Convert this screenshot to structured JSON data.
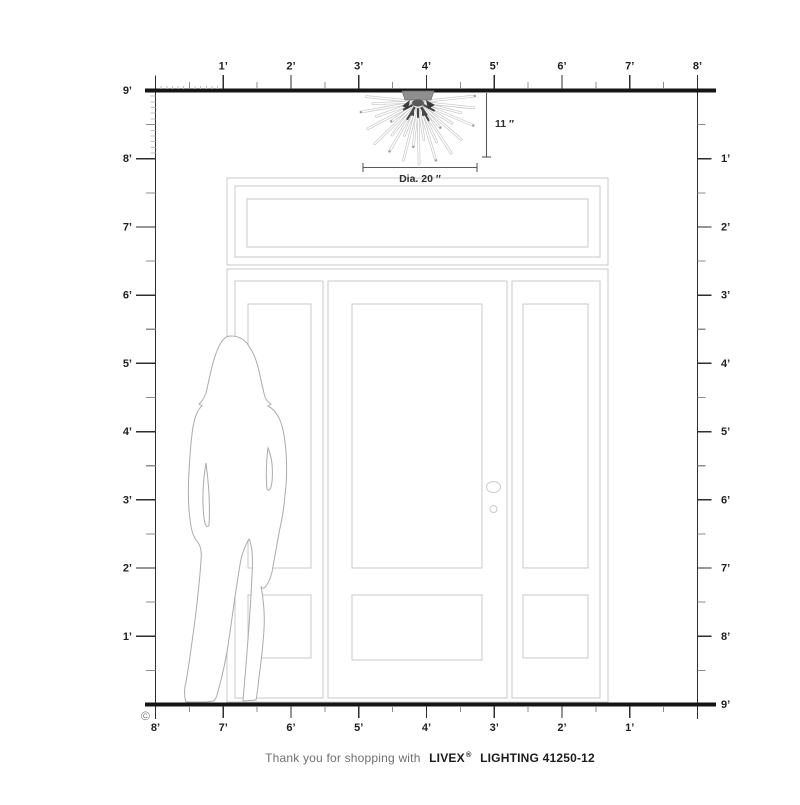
{
  "diagram": {
    "rulers": {
      "top_labels": [
        "1’",
        "2’",
        "3’",
        "4’",
        "5’",
        "6’",
        "7’",
        "8’"
      ],
      "left_labels": [
        "9’",
        "8’",
        "7’",
        "6’",
        "5’",
        "4’",
        "3’",
        "2’",
        "1’"
      ],
      "right_labels": [
        "1’",
        "2’",
        "3’",
        "4’",
        "5’",
        "6’",
        "7’",
        "8’",
        "9’"
      ],
      "bottom_labels": [
        "8’",
        "7’",
        "6’",
        "5’",
        "4’",
        "3’",
        "2’",
        "1’"
      ]
    },
    "fixture": {
      "height_label": "11 ″",
      "diameter_label": "Dia. 20 ″"
    },
    "copyright_symbol": "©"
  },
  "footer": {
    "prefix": "Thank you for shopping with",
    "brand": "LIVEX",
    "registered_mark": "®",
    "product": "LIGHTING 41250-12"
  },
  "colors": {
    "ruler_major": "#2e2e2e",
    "ruler_half": "#8c8c8c",
    "ruler_minor": "#bfbfbf",
    "door_line": "#c8c8c8",
    "silhouette_line": "#ababab",
    "dimension_line": "#5a5a5a",
    "rod_light": "#c4c4c4",
    "rod_dark": "#454545",
    "canopy": "#8f8f8f"
  }
}
